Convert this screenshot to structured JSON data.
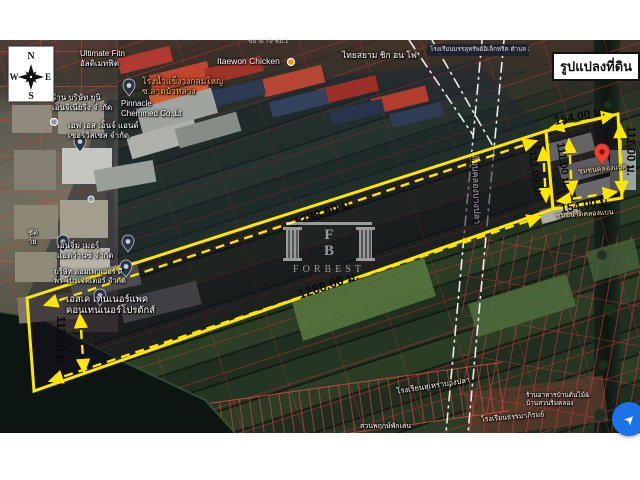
{
  "title_box": {
    "text": "รูปแปลงที่ดิน"
  },
  "compass": {
    "n": "N",
    "e": "E",
    "s": "S",
    "w": "W"
  },
  "watermark": {
    "monogram_top": "F",
    "monogram_bottom": "B",
    "brand": "FORBEST"
  },
  "measurements": {
    "length_top": "1288.00 ม.",
    "length_bottom": "1288.00 ม.",
    "width_west": "111.00 ม.",
    "width_mid_left": "111.00 ม.",
    "width_mid_right": "111.00 ม.",
    "width_east": "111.00 ม.",
    "east_top": "154.00 ม.",
    "east_bottom": "154.00 ม."
  },
  "map_labels": {
    "road_faint": "ขยาย 79 ชม.1",
    "ultimate_1": "Ultimate Fitn",
    "ultimate_2": "อัลติเมทฟิต",
    "ice_1": "โรงน้ำแข็งวงกลมใหญ่",
    "ice_2": "ซ.ลาดบัวหลวง",
    "itaewon": "Itaewon Chicken",
    "thaisiam": "ไทยสยาม ชิก อน โฟ",
    "school_tooltip": "โรงเรียนบรรลุทรัพย์อิเล็กทริค ตำบล ลำลูกกา",
    "uni_1": "ร้าน บริษัท ยูนิ",
    "uni_2": "เอ็นจิเนียริ่ง จำกัด",
    "pinnacle_1": "Pinnacle",
    "pinnacle_2": "Chemmed Co.,Lt",
    "fs_1": "เอฟ เอส เอ็นจ์ แอนด์",
    "fs_2": "เซอร์วิสเซส จำกัด",
    "frag_1": "ชัด",
    "frag_2": "าย",
    "engimer_1": "เอ็นจิ๋ม เมอร์",
    "engimer_2": "แอดว้านซ์ จำกัด",
    "ompower_1": "บริษัท ออมเพาเวอร์ ดี",
    "ompower_2": "พร โปรเจคเตอร์ จำกัด",
    "container_1": "เอสเค เทนเนอร์แพค",
    "container_2": "คอนเทนเนอร์โปรดักส์",
    "canal_road": "เลียบคลองบางปลา",
    "community_1": "ชุมชนคลองแปด",
    "community_2": "ชุมชนวัดคลองแบน",
    "school_south": "โรงเรียนสุเหร่าบางปลา",
    "garden_south": "สวนพฤกษ์พักเล่น",
    "school_south2": "โรงเรียนธรรมาภิรมย์",
    "restaurant_1": "ร้านอาหารบ้านต้นไม้&",
    "restaurant_2": "บ้านสวนริมคลอง"
  },
  "icons": {
    "directions_glyph": "➤"
  },
  "colors": {
    "plot_outline": "#ffe600",
    "cadastral_line": "#e03b33",
    "measure_text": "#0a0a0a",
    "blue_button": "#1a73e8",
    "red_pin": "#ea4335"
  }
}
